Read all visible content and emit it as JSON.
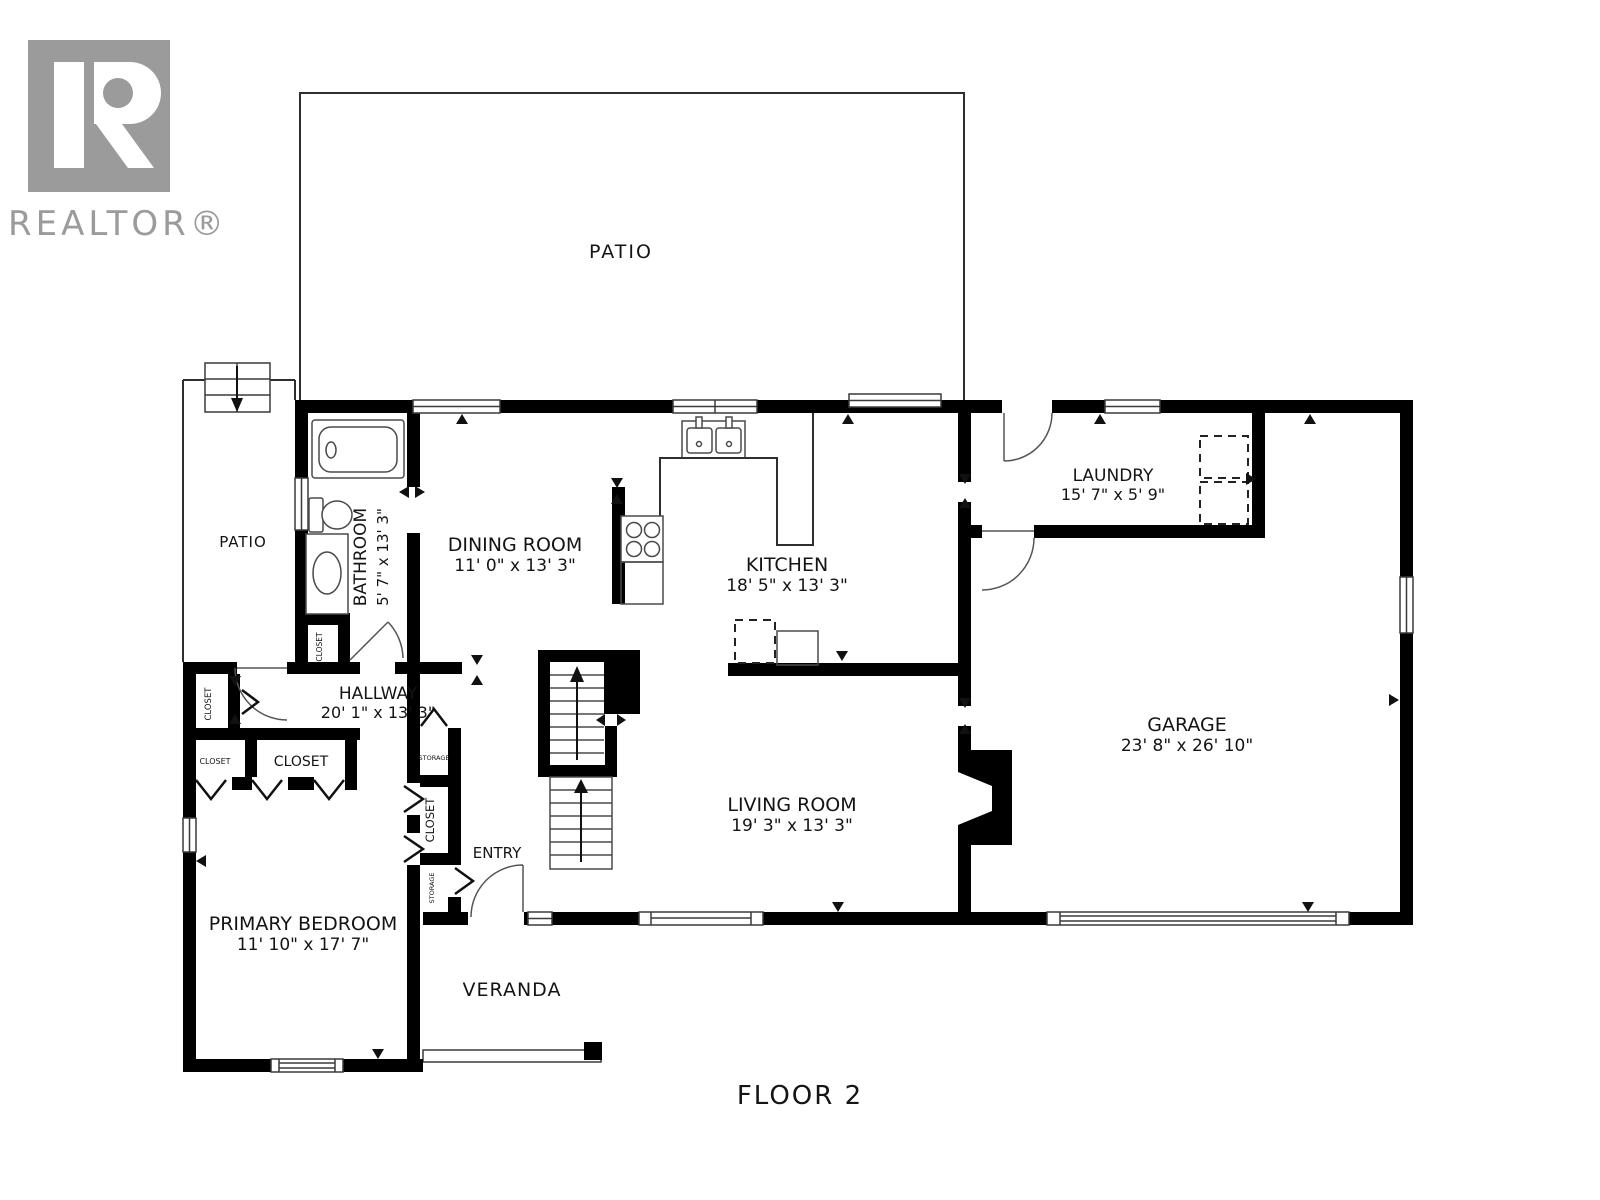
{
  "brand": {
    "logo_text": "REALTOR®"
  },
  "floor_label": "FLOOR 2",
  "rooms": {
    "patio_top": {
      "label": "PATIO"
    },
    "patio_side": {
      "label": "PATIO"
    },
    "bathroom": {
      "label": "BATHROOM",
      "dims": "5' 7\" x 13' 3\""
    },
    "dining_room": {
      "label": "DINING ROOM",
      "dims": "11' 0\" x 13' 3\""
    },
    "kitchen": {
      "label": "KITCHEN",
      "dims": "18' 5\" x 13' 3\""
    },
    "laundry": {
      "label": "LAUNDRY",
      "dims": "15' 7\" x 5' 9\""
    },
    "garage": {
      "label": "GARAGE",
      "dims": "23' 8\" x 26' 10\""
    },
    "hallway": {
      "label": "HALLWAY",
      "dims": "20' 1\" x 13' 3\""
    },
    "living_room": {
      "label": "LIVING ROOM",
      "dims": "19' 3\" x 13' 3\""
    },
    "primary_bedroom": {
      "label": "PRIMARY BEDROOM",
      "dims": "11' 10\" x 17' 7\""
    },
    "entry": {
      "label": "ENTRY"
    },
    "veranda": {
      "label": "VERANDA"
    }
  },
  "storage": {
    "closet_bathroom": "CLOSET",
    "closet_hall_upper": "CLOSET",
    "closet_hall_small": "CLOSET",
    "closet_hall_wide": "CLOSET",
    "storage_upper": "STORAGE",
    "closet_column": "CLOSET",
    "storage_lower": "STORAGE"
  },
  "colors": {
    "walls": "#000000",
    "lines": "#2e2e2e",
    "logo": "#9b9b9b",
    "text": "#141414",
    "background": "#ffffff"
  }
}
